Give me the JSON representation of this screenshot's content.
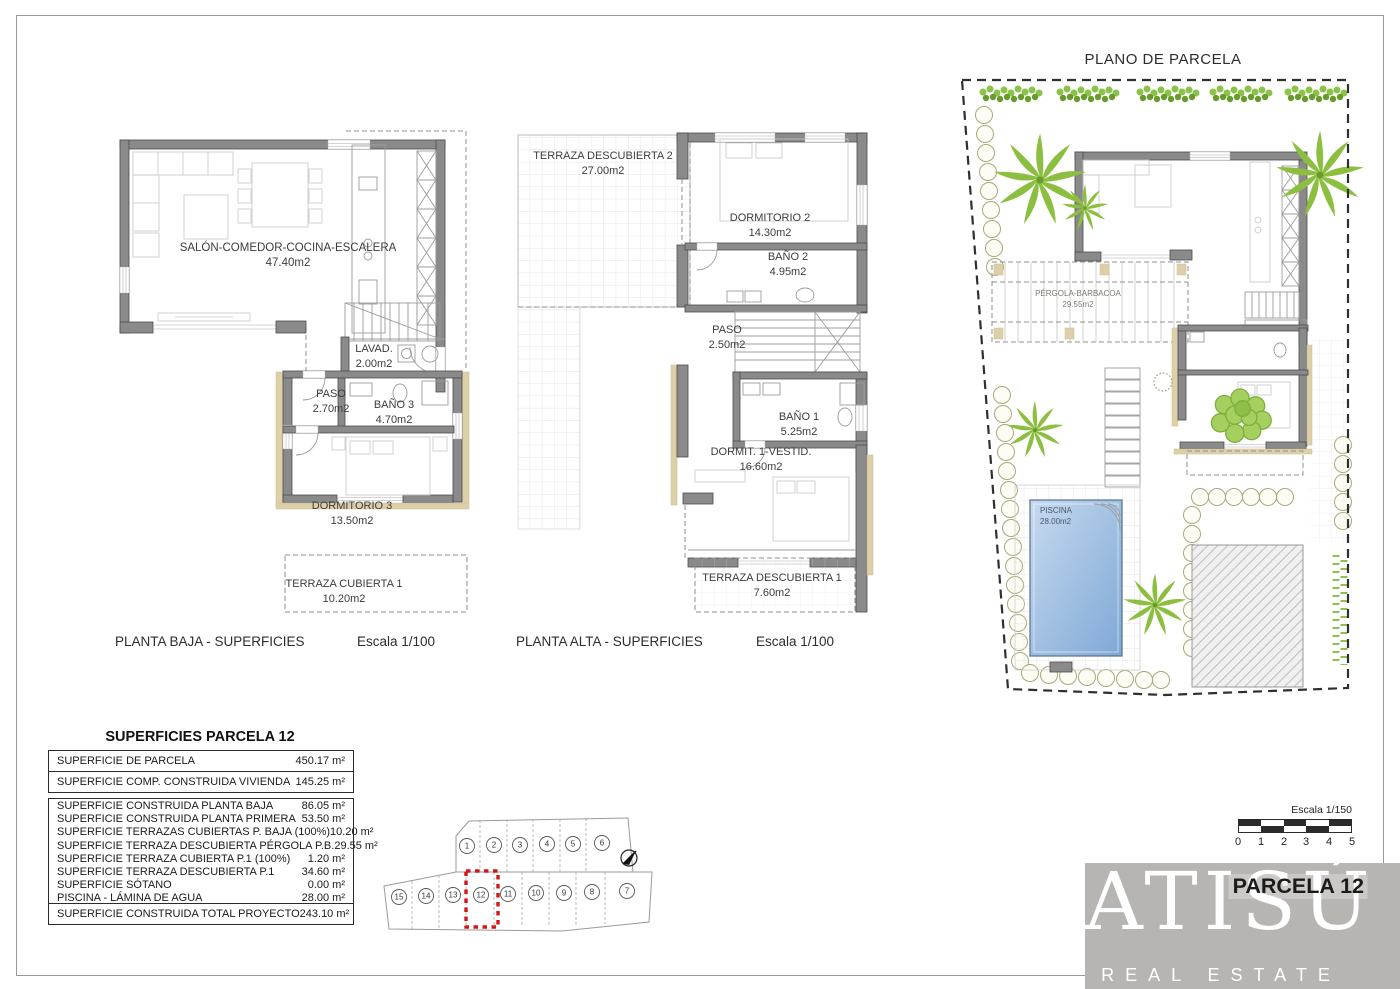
{
  "sheet": {
    "plano_parcela_title": "PLANO DE PARCELA",
    "planta_baja_title": "PLANTA BAJA - SUPERFICIES",
    "planta_baja_scale": "Escala 1/100",
    "planta_alta_title": "PLANTA ALTA - SUPERFICIES",
    "planta_alta_scale": "Escala 1/100"
  },
  "planta_baja": {
    "salon": {
      "name": "SALÓN-COMEDOR-COCINA-ESCALERA",
      "area": "47.40m2"
    },
    "lavadero": {
      "name": "LAVAD.",
      "area": "2.00m2"
    },
    "paso": {
      "name": "PASO",
      "area": "2.70m2"
    },
    "bano3": {
      "name": "BAÑO 3",
      "area": "4.70m2"
    },
    "dormitorio3": {
      "name": "DORMITORIO 3",
      "area": "13.50m2"
    },
    "terraza_cubierta1": {
      "name": "TERRAZA CUBIERTA 1",
      "area": "10.20m2"
    }
  },
  "planta_alta": {
    "terraza_descubierta2": {
      "name": "TERRAZA DESCUBIERTA 2",
      "area": "27.00m2"
    },
    "dormitorio2": {
      "name": "DORMITORIO 2",
      "area": "14.30m2"
    },
    "bano2": {
      "name": "BAÑO 2",
      "area": "4.95m2"
    },
    "paso": {
      "name": "PASO",
      "area": "2.50m2"
    },
    "bano1": {
      "name": "BAÑO 1",
      "area": "5.25m2"
    },
    "dormitorio1": {
      "name": "DORMIT. 1-VESTID.",
      "area": "16.60m2"
    },
    "terraza_descubierta1": {
      "name": "TERRAZA DESCUBIERTA 1",
      "area": "7.60m2"
    }
  },
  "plano_parcela": {
    "pergola": {
      "name": "PÉRGOLA-BARBACOA",
      "area": "29.55m2"
    },
    "piscina": {
      "name": "PISCINA",
      "area": "28.00m2"
    }
  },
  "surface_table": {
    "title": "SUPERFICIES PARCELA 12",
    "rows_top": [
      {
        "label": "SUPERFICIE DE PARCELA",
        "value": "450.17 m²"
      },
      {
        "label": "SUPERFICIE COMP. CONSTRUIDA VIVIENDA",
        "value": "145.25 m²"
      }
    ],
    "rows_detail": [
      {
        "label": "SUPERFICIE CONSTRUIDA PLANTA BAJA",
        "value": "86.05 m²"
      },
      {
        "label": "SUPERFICIE CONSTRUIDA PLANTA PRIMERA",
        "value": "53.50 m²"
      },
      {
        "label": "SUPERFICIE TERRAZAS CUBIERTAS P. BAJA (100%)",
        "value": "10.20 m²"
      },
      {
        "label": "SUPERFICIE TERRAZA DESCUBIERTA PÉRGOLA P.B.",
        "value": "29.55 m²"
      },
      {
        "label": "SUPERFICIE TERRAZA CUBIERTA P.1 (100%)",
        "value": "1.20 m²"
      },
      {
        "label": "SUPERFICIE TERRAZA DESCUBIERTA P.1",
        "value": "34.60 m²"
      },
      {
        "label": "SUPERFICIE SÓTANO",
        "value": "0.00 m²"
      },
      {
        "label": "PISCINA - LÁMINA DE AGUA",
        "value": "28.00 m²"
      }
    ],
    "row_total": {
      "label": "SUPERFICIE CONSTRUIDA TOTAL PROYECTO",
      "value": "243.10 m²"
    }
  },
  "lot_map": {
    "top": [
      "1",
      "2",
      "3",
      "4",
      "5",
      "6"
    ],
    "bottom": [
      "15",
      "14",
      "13",
      "12",
      "11",
      "10",
      "9",
      "8",
      "7"
    ],
    "highlighted_lot": "12"
  },
  "scale_bar": {
    "label": "Escala 1/150",
    "ticks": [
      "0",
      "1",
      "2",
      "3",
      "4",
      "5"
    ]
  },
  "branding": {
    "logo_text": "ATISÚ",
    "logo_subtitle": "REAL ESTATE",
    "parcela_label": "PARCELA 12"
  },
  "colors": {
    "wall_gray": "#8a8a8a",
    "accent_tan": "#ddd0a8",
    "highlight_red": "#d01818",
    "plant_green": "#8bc34a",
    "pool_blue": "#7fa8d6",
    "logo_gray": "#b7b5b1"
  }
}
